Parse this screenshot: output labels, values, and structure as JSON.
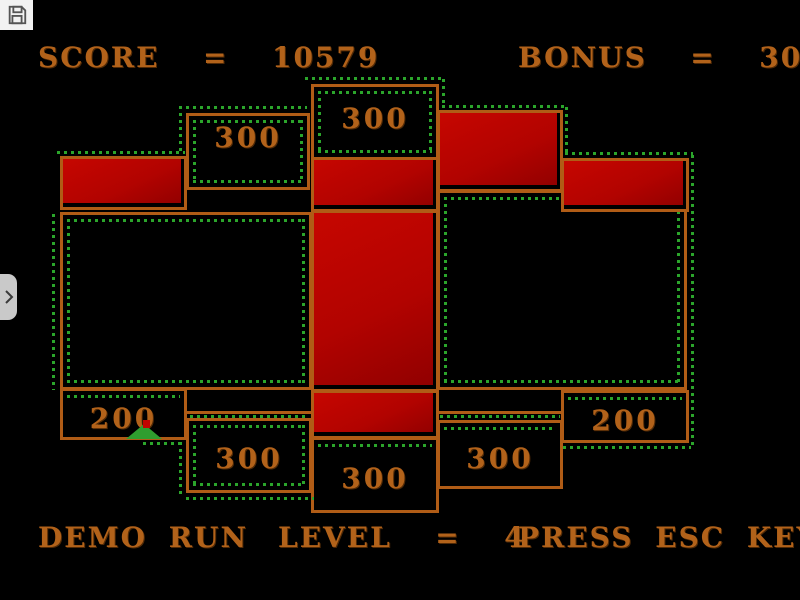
{
  "hud": {
    "score": "SCORE  =  10579",
    "bonus": "BONUS  =  3020",
    "demo": "DEMO RUN",
    "level": "LEVEL  =  4",
    "press": "PRESS ESC KEY"
  },
  "overlay": {
    "save_icon": "floppy-disk-icon",
    "side_tab_icon": "chevron-right-icon"
  },
  "colors": {
    "wall_orange": "#b05c16",
    "text_orange": "#b2621a",
    "trail_green": "#2ba52b",
    "block_red": "#b20300",
    "background": "#000000"
  },
  "board": {
    "boxes": [
      {
        "x": 186,
        "y": 113,
        "w": 124,
        "h": 77,
        "label": "300",
        "label_top": 8,
        "trail": "inset"
      },
      {
        "x": 311,
        "y": 84,
        "w": 128,
        "h": 76,
        "label": "300",
        "label_top": 18,
        "trail": "inset"
      },
      {
        "x": 60,
        "y": 212,
        "w": 252,
        "h": 178,
        "label": "",
        "trail": "inset"
      },
      {
        "x": 437,
        "y": 190,
        "w": 250,
        "h": 200,
        "label": "",
        "trail": "inset"
      },
      {
        "x": 60,
        "y": 388,
        "w": 127,
        "h": 52,
        "label": "200",
        "label_top": 14,
        "trail": "top"
      },
      {
        "x": 561,
        "y": 390,
        "w": 128,
        "h": 53,
        "label": "200",
        "label_top": 14,
        "trail": "top"
      },
      {
        "x": 186,
        "y": 418,
        "w": 126,
        "h": 75,
        "label": "300",
        "label_top": 24,
        "trail": "inset"
      },
      {
        "x": 311,
        "y": 437,
        "w": 128,
        "h": 76,
        "label": "300",
        "label_top": 25,
        "trail": "top"
      },
      {
        "x": 437,
        "y": 420,
        "w": 126,
        "h": 69,
        "label": "300",
        "label_top": 22,
        "trail": "top"
      }
    ],
    "red_blocks": [
      {
        "x": 60,
        "y": 156,
        "w": 127,
        "h": 54
      },
      {
        "x": 311,
        "y": 157,
        "w": 128,
        "h": 55
      },
      {
        "x": 311,
        "y": 210,
        "w": 128,
        "h": 182
      },
      {
        "x": 311,
        "y": 390,
        "w": 128,
        "h": 49
      },
      {
        "x": 437,
        "y": 110,
        "w": 126,
        "h": 82
      },
      {
        "x": 561,
        "y": 158,
        "w": 128,
        "h": 54
      }
    ],
    "walls": [
      {
        "x": 186,
        "y": 411,
        "l": 126
      },
      {
        "x": 437,
        "y": 411,
        "l": 126
      }
    ],
    "trails": [
      {
        "o": "h",
        "x": 305,
        "y": 77,
        "l": 138
      },
      {
        "o": "v",
        "x": 442,
        "y": 79,
        "l": 28
      },
      {
        "o": "h",
        "x": 442,
        "y": 105,
        "l": 126
      },
      {
        "o": "v",
        "x": 565,
        "y": 107,
        "l": 48
      },
      {
        "o": "h",
        "x": 565,
        "y": 152,
        "l": 128
      },
      {
        "o": "v",
        "x": 691,
        "y": 155,
        "l": 292
      },
      {
        "o": "h",
        "x": 563,
        "y": 446,
        "l": 128
      },
      {
        "o": "v",
        "x": 52,
        "y": 214,
        "l": 176
      },
      {
        "o": "h",
        "x": 57,
        "y": 151,
        "l": 128
      },
      {
        "o": "v",
        "x": 179,
        "y": 106,
        "l": 47
      },
      {
        "o": "h",
        "x": 179,
        "y": 106,
        "l": 128
      },
      {
        "o": "h",
        "x": 186,
        "y": 497,
        "l": 128
      },
      {
        "o": "v",
        "x": 179,
        "y": 442,
        "l": 56
      },
      {
        "o": "h",
        "x": 143,
        "y": 442,
        "l": 40
      },
      {
        "o": "h",
        "x": 190,
        "y": 415,
        "l": 118
      },
      {
        "o": "h",
        "x": 440,
        "y": 415,
        "l": 120
      }
    ],
    "player": {
      "x": 126,
      "y": 424,
      "dot_x": 143,
      "dot_y": 420
    }
  }
}
